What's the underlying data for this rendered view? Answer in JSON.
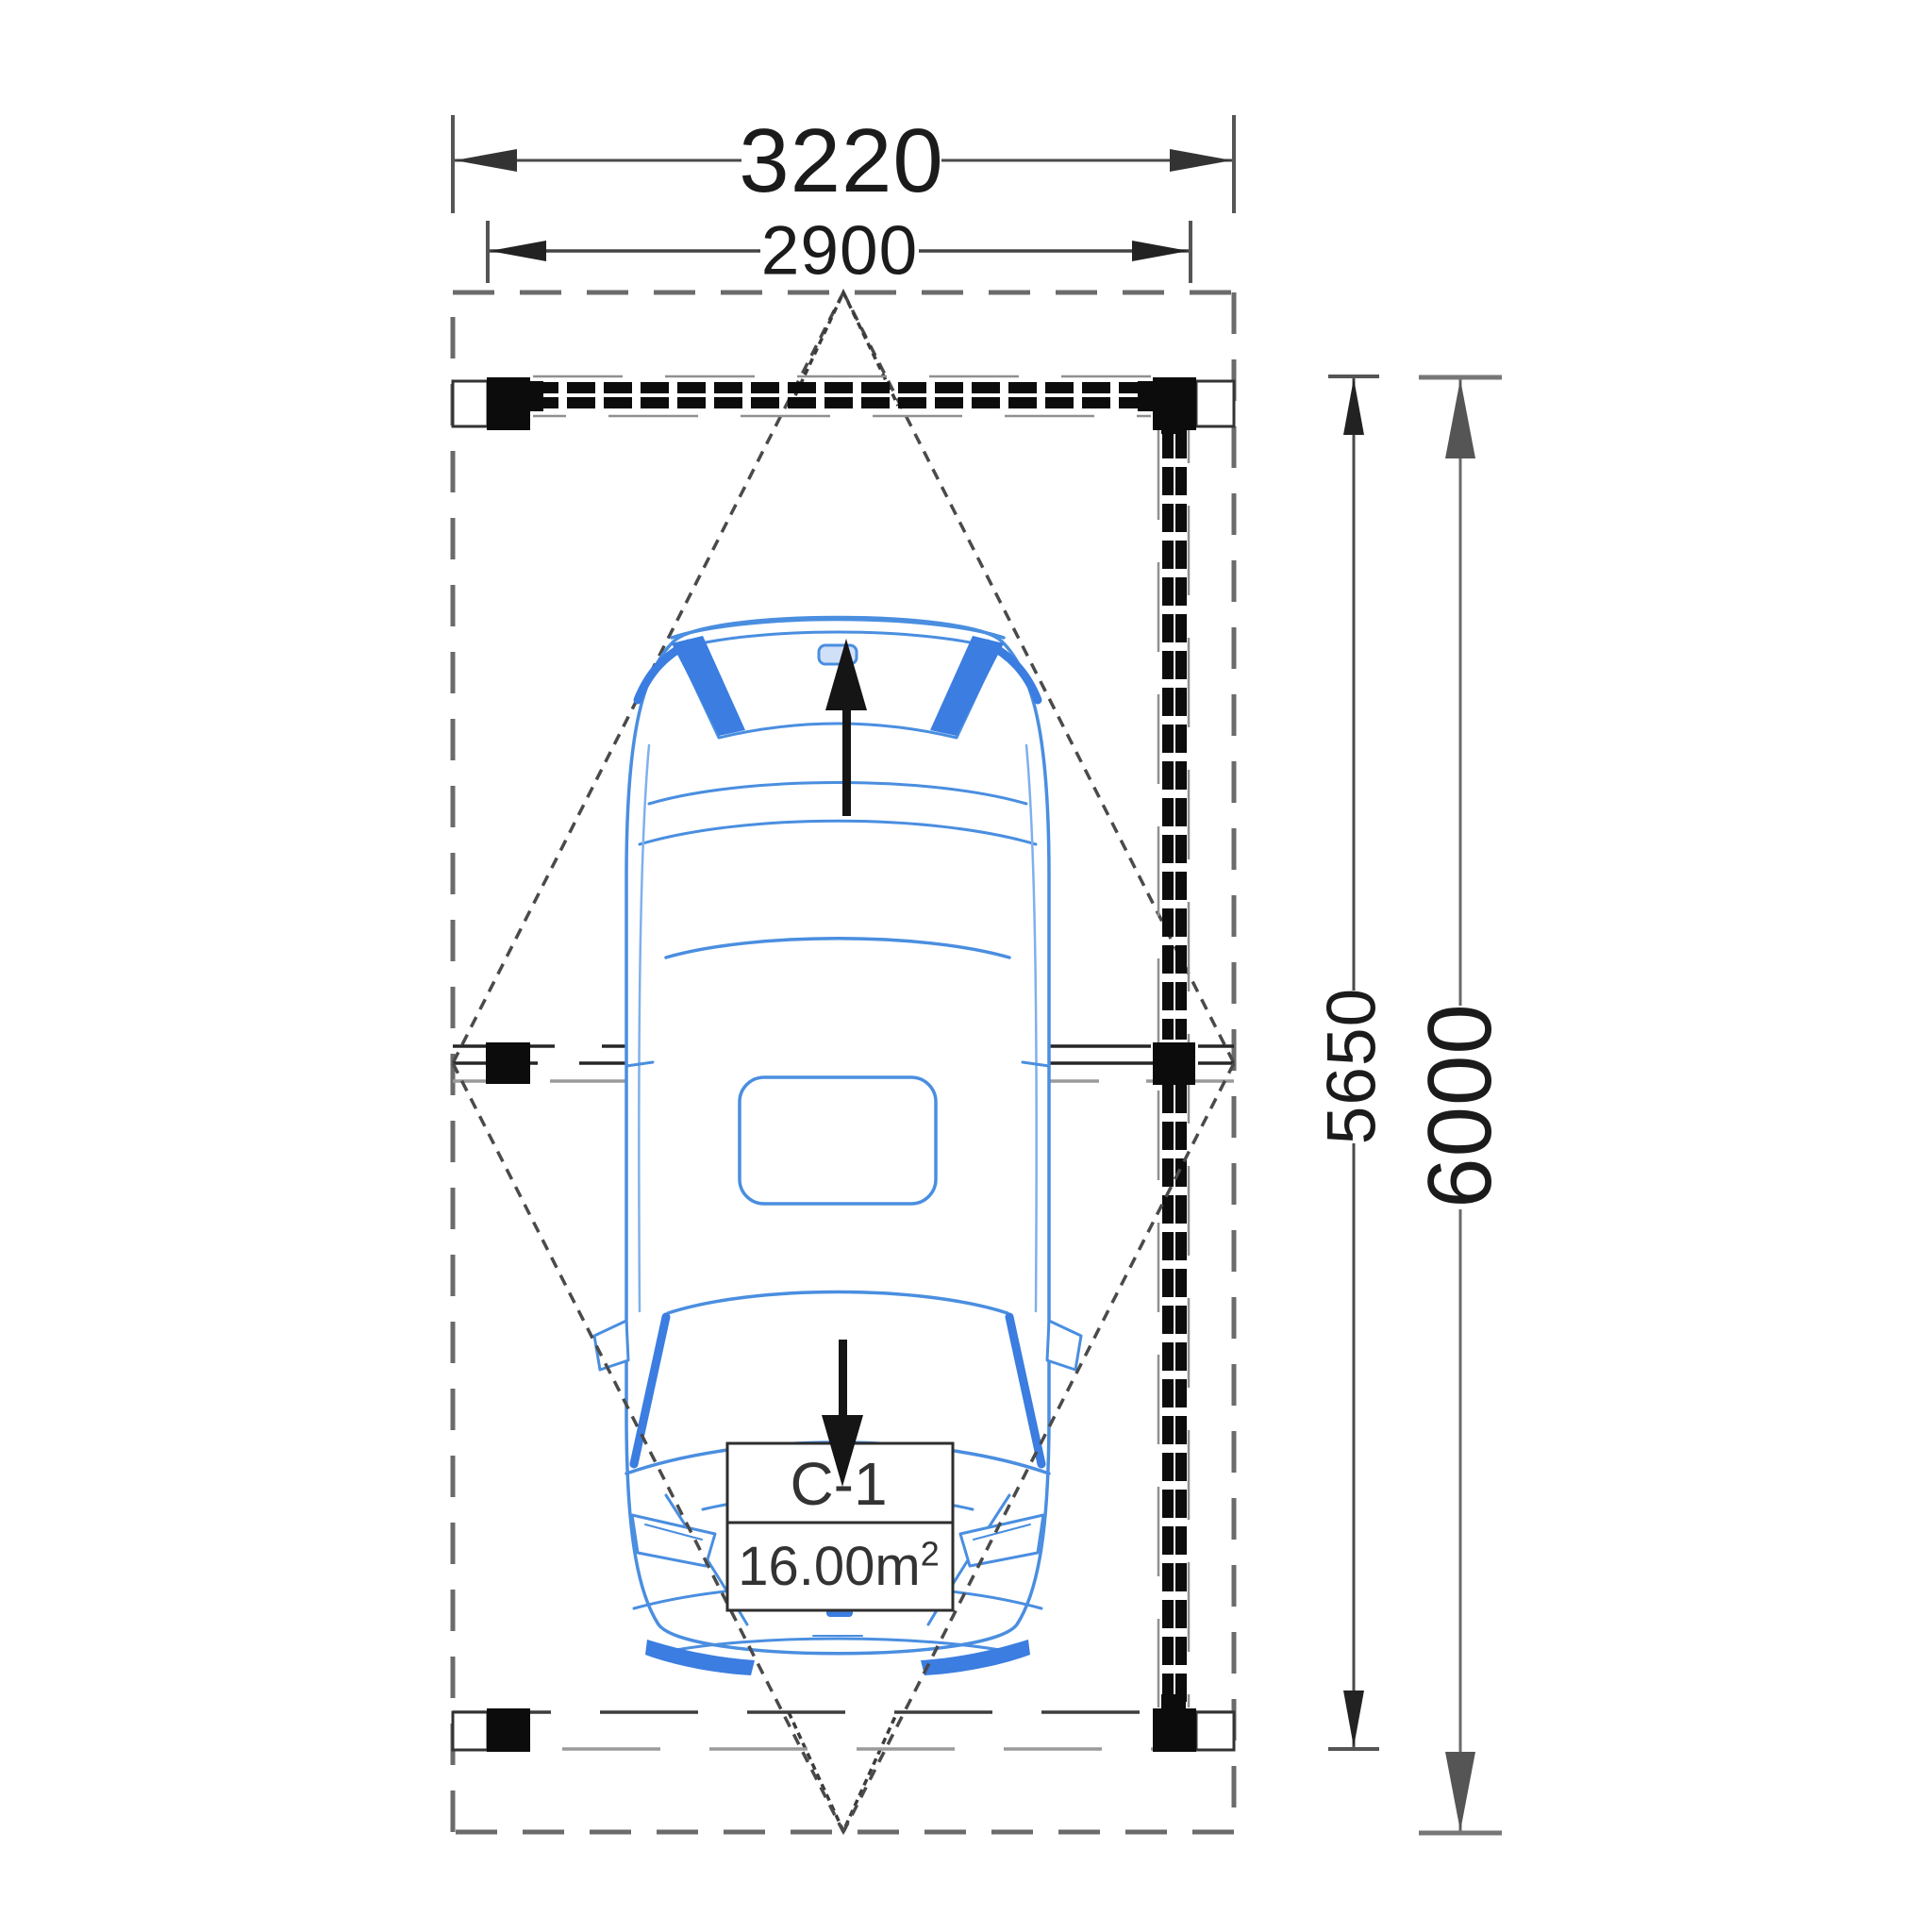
{
  "dimensions": {
    "roof_width": "3220",
    "post_span_width": "2900",
    "wall_length": "5650",
    "total_depth": "6000"
  },
  "space": {
    "name": "C-1",
    "area": "16.00m²",
    "area_base": "16.00m",
    "area_exponent": "2"
  },
  "colors": {
    "car_outline": "#4a8ee0",
    "car_accent": "#3b7de0",
    "linework_dark": "#0c0c0c",
    "linework_gray": "#5a5a5a",
    "dashed_outline": "#6b6b6b"
  }
}
